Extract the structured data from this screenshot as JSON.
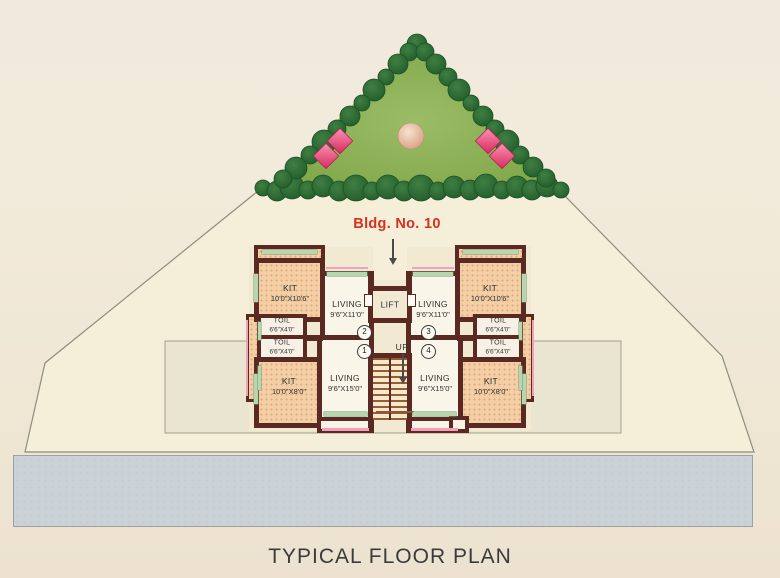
{
  "annotation": {
    "building_label": "Bldg. No. 10"
  },
  "title": "TYPICAL FLOOR PLAN",
  "plan": {
    "lift": "LIFT",
    "up": "UP",
    "flats": {
      "f1": "1",
      "f2": "2",
      "f3": "3",
      "f4": "4"
    },
    "rooms": {
      "kit_upper": {
        "label": "KIT",
        "dims": "10'0\"X10'6\""
      },
      "living_upper": {
        "label": "LIVING",
        "dims": "9'6\"X11'0\""
      },
      "toil": {
        "label": "TOIL",
        "dims": "6'6\"X4'0\""
      },
      "living_lower": {
        "label": "LIVING",
        "dims": "9'6\"X15'0\""
      },
      "kit_lower": {
        "label": "KIT",
        "dims": "10'0\"X8'0\""
      }
    }
  },
  "palette": {
    "label_red": "#d6301f",
    "wall_maroon": "#5a2a22",
    "grass_green": "#8db257",
    "tree_green": "#2a6b33",
    "kitchen_peach": "#f4cfa6",
    "road_gray": "#c9d2d7",
    "sill_green": "#b7d6b0",
    "window_pink": "#f2a0bb"
  }
}
